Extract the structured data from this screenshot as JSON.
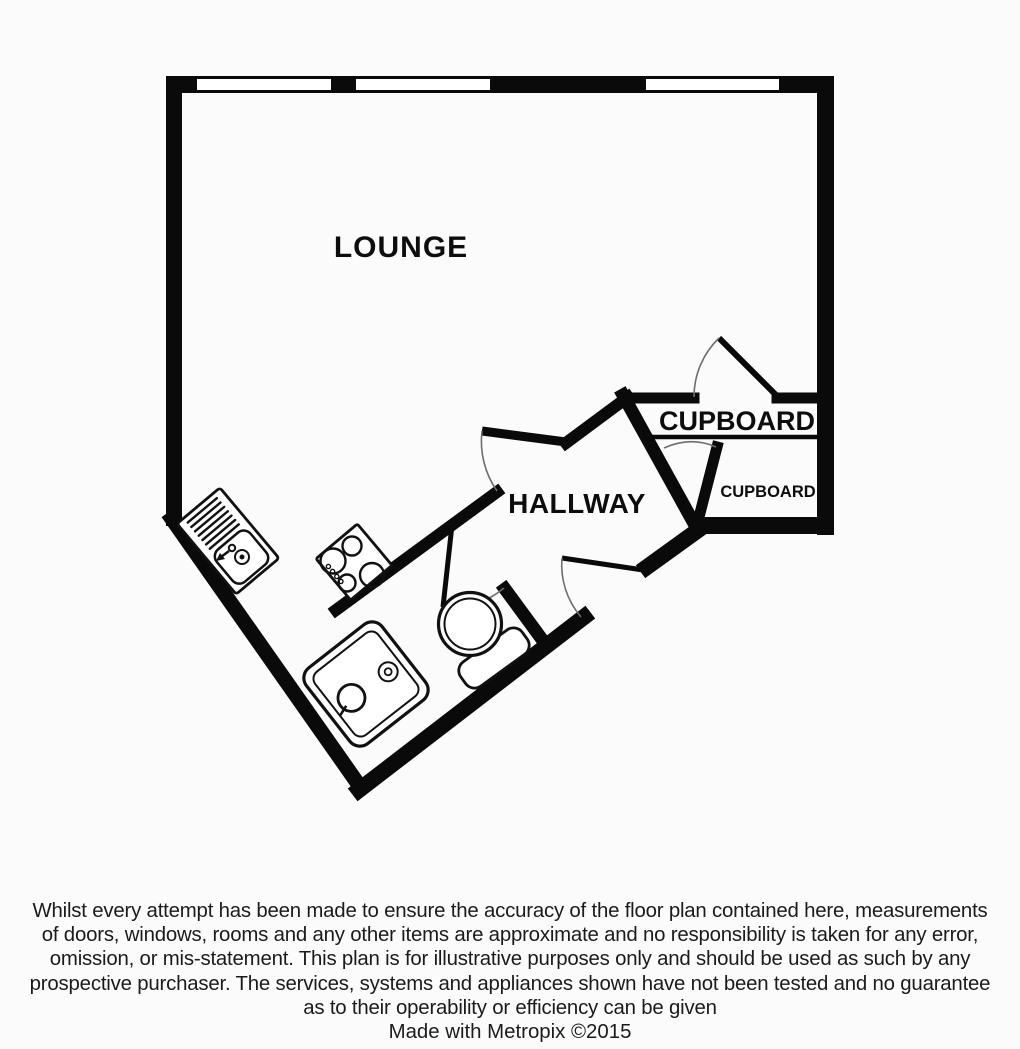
{
  "plan": {
    "rooms": {
      "lounge": "LOUNGE",
      "hallway": "HALLWAY",
      "cupboard_large": "CUPBOARD",
      "cupboard_small": "CUPBOARD"
    },
    "fixtures": [
      "kitchen-sink",
      "hob",
      "shower-tray",
      "toilet"
    ],
    "windows_count": "3"
  },
  "colors": {
    "walls": "#0a0a0a",
    "background": "#fbfbfb",
    "text": "#1b1b1b"
  },
  "disclaimer": {
    "lines": [
      "Whilst every attempt has been made to ensure the accuracy of the floor plan contained here, measurements",
      "of doors, windows, rooms and any other items are approximate and no responsibility is taken for any error,",
      "omission, or mis-statement. This plan is for illustrative purposes only and should be used as such by any",
      "prospective purchaser. The services, systems and appliances shown have not been tested and no guarantee",
      "as to their operability or efficiency can be given"
    ]
  },
  "credit": "Made with Metropix ©2015"
}
